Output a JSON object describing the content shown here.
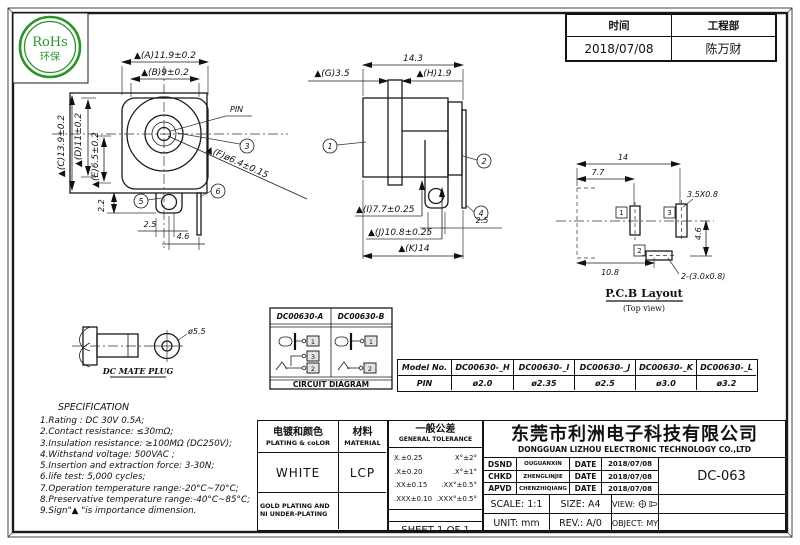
{
  "rohs": {
    "line1": "RoHs",
    "line2": "环保"
  },
  "header": {
    "time_label": "时间",
    "dept_label": "工程部",
    "time_value": "2018/07/08",
    "dept_value": "陈万财"
  },
  "front_view": {
    "dim_a": "▲(A)11.9±0.2",
    "dim_b": "▲(B)9±0.2",
    "dim_c": "▲(C)13.9±0.2",
    "dim_d": "▲(D)11±0.2",
    "dim_e": "▲(E)6.5±0.2",
    "dim_f": "▲(F)ø6.4±0.15",
    "pin_label": "PIN",
    "dim_2_2": "2.2",
    "dim_2_5": "2.5",
    "dim_4_6": "4.6",
    "balloon_3": "3",
    "balloon_5": "5",
    "balloon_6": "6"
  },
  "side_view": {
    "dim_14_3": "14.3",
    "dim_g": "▲(G)3.5",
    "dim_h": "▲(H)1.9",
    "dim_i": "▲(I)7.7±0.25",
    "dim_j": "▲(J)10.8±0.25",
    "dim_k": "▲(K)14",
    "dim_2_5": "2.5",
    "balloon_1": "1",
    "balloon_2": "2",
    "balloon_4": "4"
  },
  "pcb": {
    "dim_14": "14",
    "dim_7_7": "7.7",
    "slot_note": "3.5X0.8",
    "dim_4_6": "4.6",
    "dim_10_8": "10.8",
    "slots_note": "2-(3.0x0.8)",
    "pad_1": "1",
    "pad_2": "2",
    "pad_3": "3",
    "title": "P.C.B Layout",
    "subtitle": "(Top view)"
  },
  "plug": {
    "dim_dia": "ø5.5",
    "label": "DC MATE PLUG"
  },
  "circuit": {
    "model_a": "DC00630-A",
    "model_b": "DC00630-B",
    "title": "CIRCUIT DIAGRAM",
    "a_term_1": "1",
    "a_term_3": "3",
    "a_term_2": "2",
    "b_term_1": "1",
    "b_term_2": "2"
  },
  "model_table": {
    "headers": [
      "Model No.",
      "DC00630-_H",
      "DC00630-_I",
      "DC00630-_J",
      "DC00630-_K",
      "DC00630-_L"
    ],
    "pin_row": [
      "PIN",
      "ø2.0",
      "ø2.35",
      "ø2.5",
      "ø3.0",
      "ø3.2"
    ]
  },
  "specification": {
    "title": "SPECIFICATION",
    "lines": [
      "1.Rating : DC 30V 0.5A;",
      "2.Contact resistance: ≤30mΩ;",
      "3.Insulation resistance: ≥100MΩ (DC250V);",
      "4.Withstand voltage: 500VAC ;",
      "5.Insertion and extraction force: 3-30N;",
      "6.life test: 5,000 cycles;",
      "7.Operation temperature range:-20°C~70°C;",
      "8.Preservative temperature range:-40°C~85°C;",
      "9.Sign\"▲ \"is importance dimension."
    ]
  },
  "title_block": {
    "plating_cn": "电镀和颜色",
    "plating_en": "PLATING & coLOR",
    "material_cn": "材料",
    "material_en": "MATERIAL",
    "plating_value": "WHITE",
    "material_value": "LCP",
    "plating_note": "GOLD PLATING AND NI UNDER-PLATING",
    "tol_cn": "一般公差",
    "tol_en": "GENERAL TOLERANCE",
    "tol_rows": [
      [
        "X.±0.25",
        "X°±2°"
      ],
      [
        ".X±0.20",
        ".X°±1°"
      ],
      [
        ".XX±0.15",
        ".XX°±0.5°"
      ],
      [
        ".XXX±0.10",
        ".XXX°±0.5°"
      ]
    ],
    "sheet": "SHEET 1 OF 1",
    "company_cn": "东莞市利洲电子科技有限公司",
    "company_en": "DONGGUAN LIZHOU ELECTRONIC TECHNOLOGY CO.,LTD",
    "approvals": [
      {
        "role": "DSND",
        "name": "OUGUANXIN",
        "date_label": "DATE",
        "date": "2018/07/08"
      },
      {
        "role": "CHKD",
        "name": "ZHENGLINJIE",
        "date_label": "DATE",
        "date": "2018/07/08"
      },
      {
        "role": "APVD",
        "name": "CHENZHIQIANG",
        "date_label": "DATE",
        "date": "2018/07/08"
      }
    ],
    "part_no": "DC-063",
    "scale_label": "SCALE:",
    "scale_value": "1:1",
    "size_label": "SIZE:",
    "size_value": "A4",
    "view_label": "VIEW:",
    "unit_label": "UNIT:",
    "unit_value": "mm",
    "rev_label": "REV.:",
    "rev_value": "A/0",
    "object_label": "OBJECT:",
    "object_value": "MY"
  }
}
